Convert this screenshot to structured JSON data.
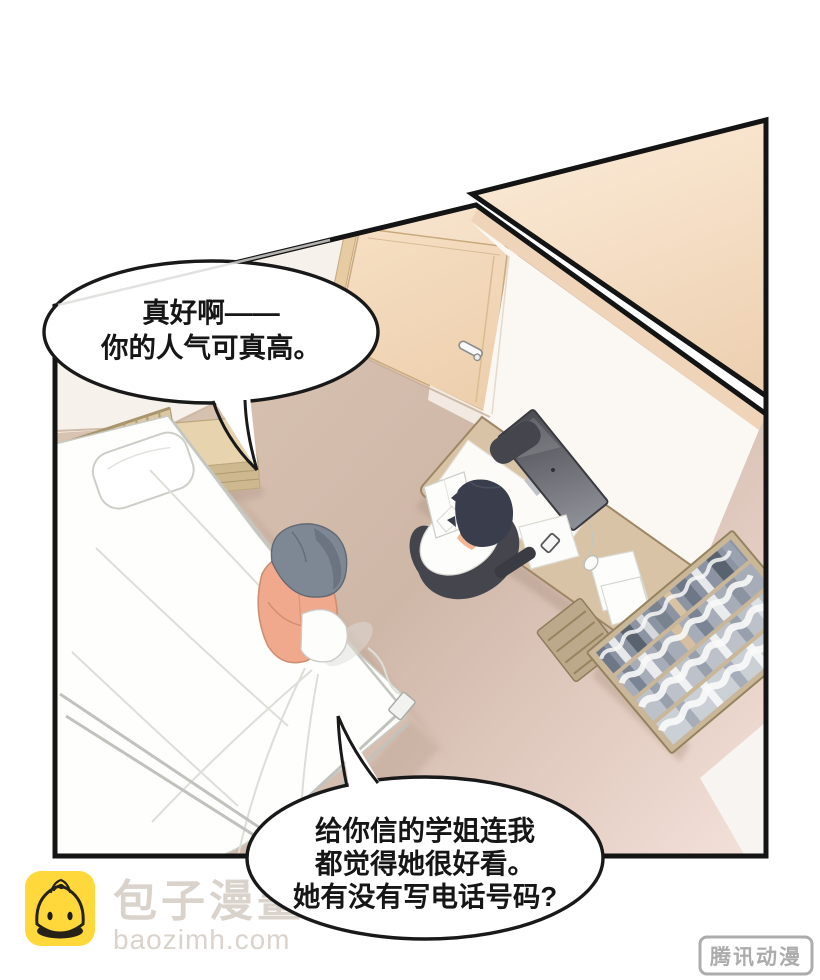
{
  "bubbles": {
    "top": {
      "lines": [
        "真好啊——",
        "你的人气可真高。"
      ]
    },
    "bottom": {
      "lines": [
        "给你信的学姐连我",
        "都觉得她很好看。",
        "她有没有写电话号码?"
      ]
    }
  },
  "watermarks": {
    "baozi": {
      "site_name": "包子漫畫",
      "site_url": "baozimh.com",
      "icon": "baozi-bun-icon",
      "icon_bg": "#FFD83C",
      "text_color": "#D9D3CC"
    },
    "tencent": {
      "label": "腾讯动漫",
      "color": "#ACACAC"
    }
  },
  "scene": {
    "description": "overhead manga panel of a bedroom: one person sitting on a bed, another at a desk with a monitor, bookshelf by the wall, door at top",
    "objects": [
      "bed",
      "pillow",
      "headboard",
      "nightstand",
      "door",
      "door-handle",
      "light-switch",
      "desk",
      "monitor",
      "desk-mat",
      "papers",
      "mouse",
      "office-chair",
      "person-at-desk",
      "person-on-bed",
      "bookshelf",
      "drawer-unit"
    ],
    "colors": {
      "panel_border": "#141414",
      "floor": "#CFB7A8",
      "wall_peach": "#F4DEC6",
      "wall_white": "#FBF7F3",
      "door": "#F2D8B9",
      "desk": "#D8C3A7",
      "mattress": "#FEFEFD",
      "skin": "#F1A98D",
      "hair_gray": "#7E8794",
      "hair_dark": "#3A3D4C",
      "chair": "#45454E",
      "bookshelf_frame": "#CAB79A"
    }
  }
}
